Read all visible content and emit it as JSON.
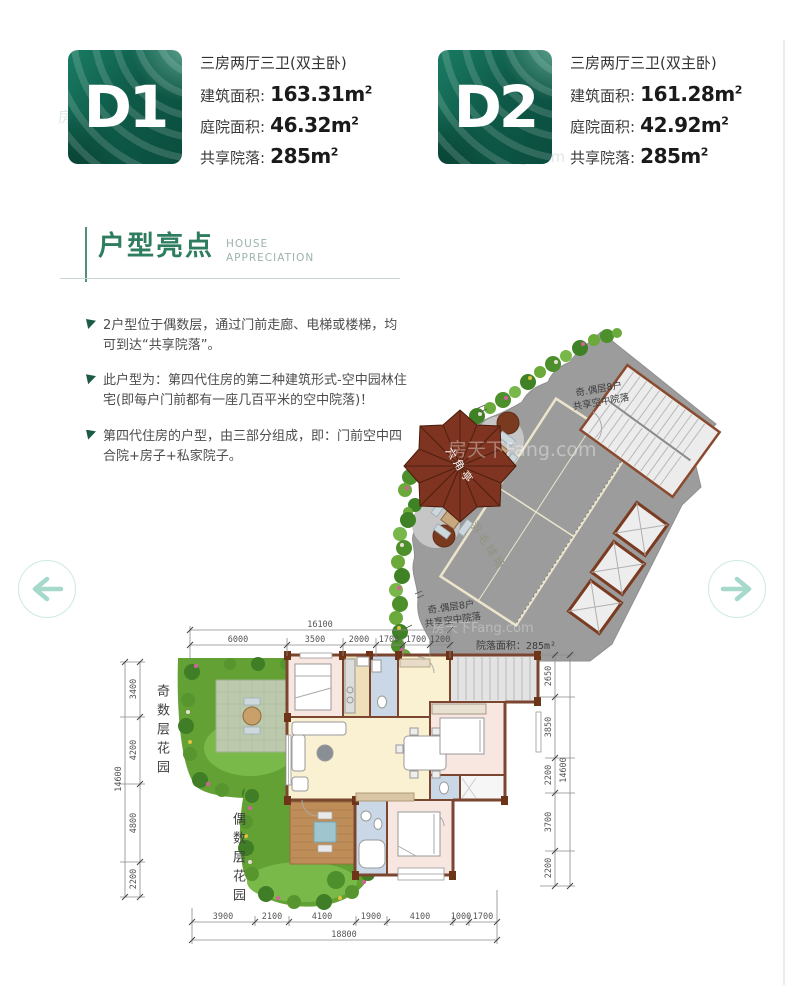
{
  "units": [
    {
      "code": "D1",
      "layout_type": "三房两厅三卫(双主卧)",
      "specs": [
        {
          "label": "建筑面积:",
          "value": "163.31m",
          "sup": "2"
        },
        {
          "label": "庭院面积:",
          "value": "46.32m",
          "sup": "2"
        },
        {
          "label": "共享院落:",
          "value": "285m",
          "sup": "2"
        }
      ]
    },
    {
      "code": "D2",
      "layout_type": "三房两厅三卫(双主卧)",
      "specs": [
        {
          "label": "建筑面积:",
          "value": "161.28m",
          "sup": "2"
        },
        {
          "label": "庭院面积:",
          "value": "42.92m",
          "sup": "2"
        },
        {
          "label": "共享院落:",
          "value": "285m",
          "sup": "2"
        }
      ]
    }
  ],
  "section": {
    "title": "户型亮点",
    "subtitle_top": "HOUSE",
    "subtitle_bottom": "APPRECIATION"
  },
  "highlights": [
    {
      "text": "2户型位于偶数层，通过门前走廊、电梯或楼梯，均可到达“共享院落”。"
    },
    {
      "text": "此户型为：第四代住房的第二种建筑形式-空中园林住宅(即每户门前都有一座几百平米的空中院落)！"
    },
    {
      "text": "第四代住房的户型，由三部分组成，即：门前空中四合院+房子+私家院子。"
    }
  ],
  "plan": {
    "courtyard": {
      "share_label_line1": "奇.偶层8户",
      "share_label_line2": "共享空中院落",
      "area_label": "院落面积：285m²",
      "pavilion_label": "六角亭",
      "court_label": "羽毛球场"
    },
    "gardens": {
      "odd_label": "奇数层花园",
      "even_label": "偶数层花园"
    },
    "dims": {
      "top": {
        "total": "16100",
        "segments": [
          "6000",
          "3500",
          "2000",
          "1700",
          "1700",
          "1200"
        ]
      },
      "bottom": {
        "total": "18800",
        "segments": [
          "3900",
          "2100",
          "4100",
          "1900",
          "4100",
          "1000",
          "1700"
        ]
      },
      "left": {
        "total": "14600",
        "segments": [
          "3400",
          "4200",
          "4800",
          "2200"
        ]
      },
      "right": {
        "total": "14600",
        "segments": [
          "2650",
          "3850",
          "2200",
          "3700",
          "2200"
        ]
      }
    }
  },
  "watermark": {
    "text": "房天下Fang.com"
  },
  "nav": {
    "prev_icon": "arrow-left-icon",
    "next_icon": "arrow-right-icon"
  },
  "colors": {
    "accent_green": "#2f7d5f",
    "badge_teal": "#0e5a48",
    "mint": "#a6d9cc",
    "wall_brown": "#7a4630",
    "courtyard_gray": "#9c9c9c"
  }
}
